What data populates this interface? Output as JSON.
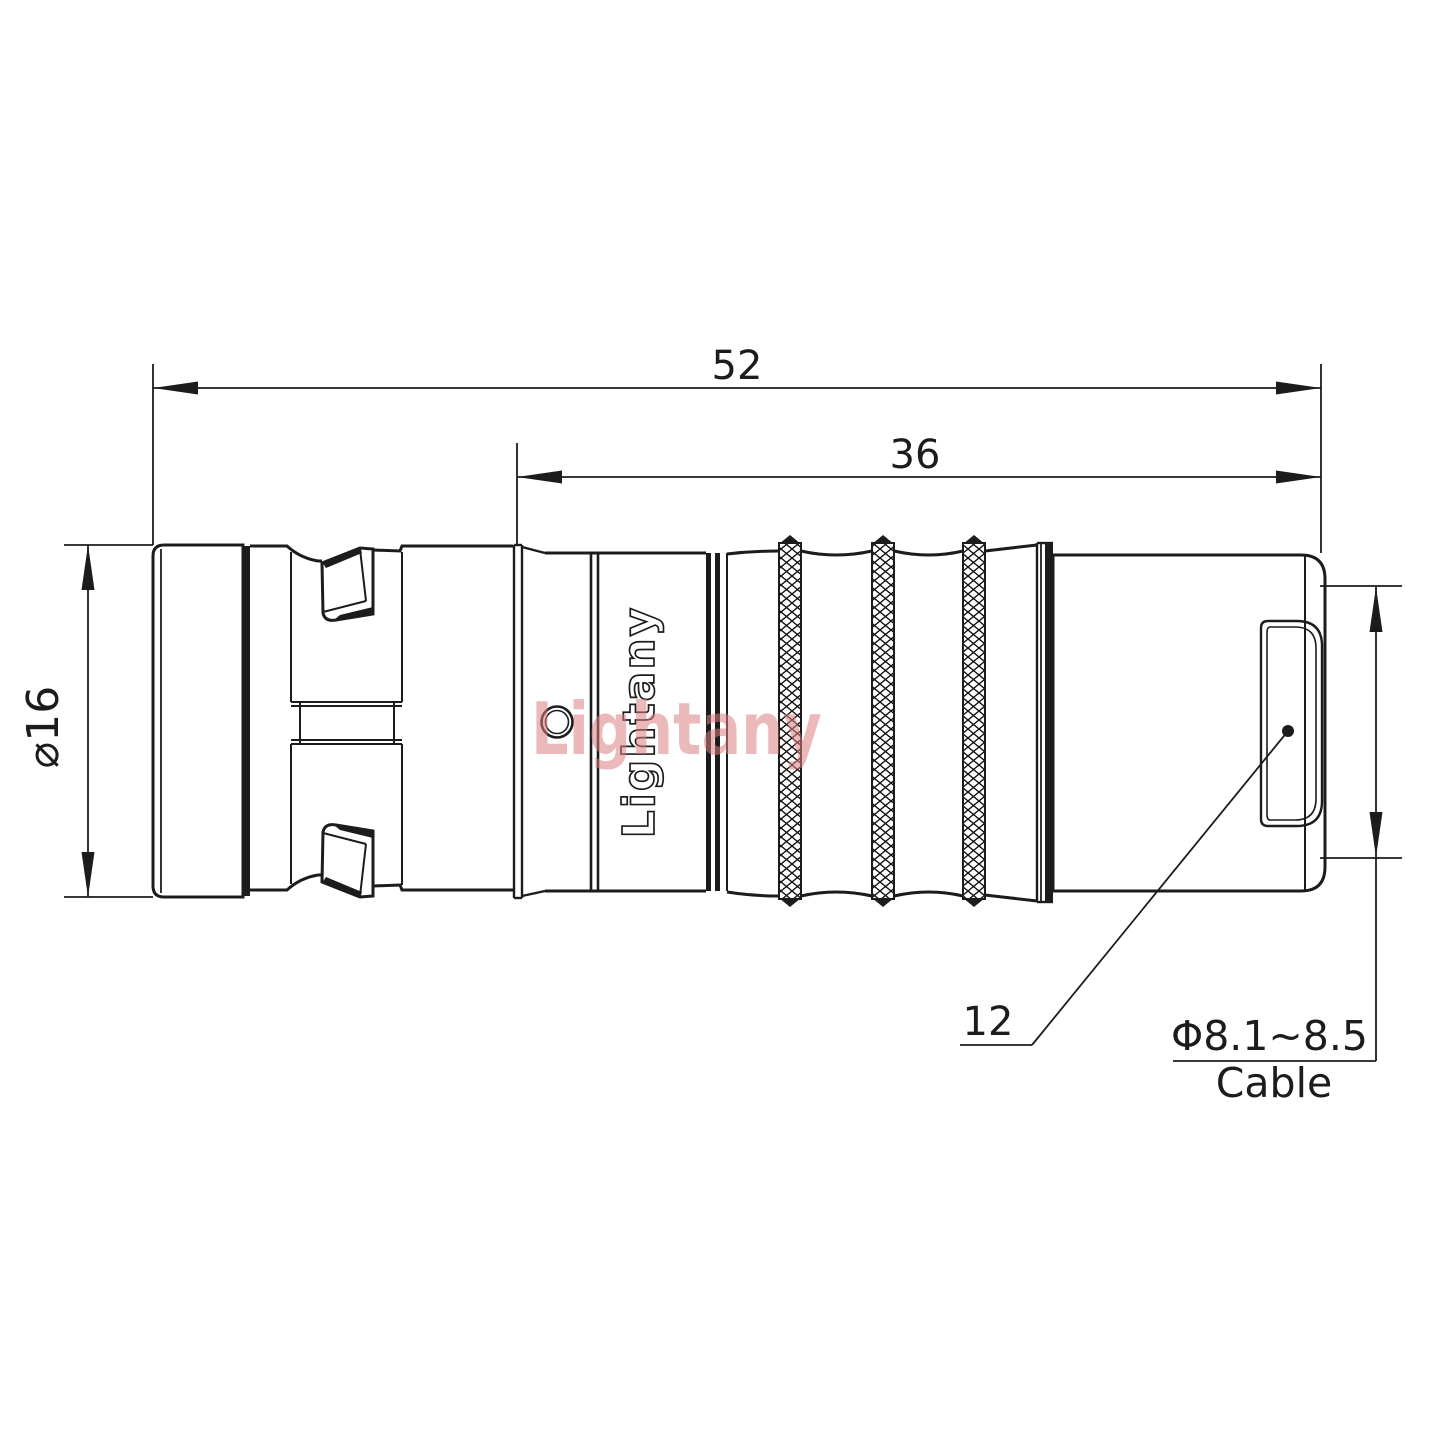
{
  "page": {
    "background": "#ffffff"
  },
  "drawing": {
    "line_color": "#1c1c1c",
    "watermark": {
      "text": "Lightany",
      "color": "#db8080"
    },
    "engraving": {
      "text": "Lightany"
    },
    "dims": {
      "overall_length": "52",
      "rear_length": "36",
      "diameter": "⌀16",
      "boot_ref": "12",
      "cable_range": "Φ8.1~8.5",
      "cable_word": "Cable"
    }
  }
}
